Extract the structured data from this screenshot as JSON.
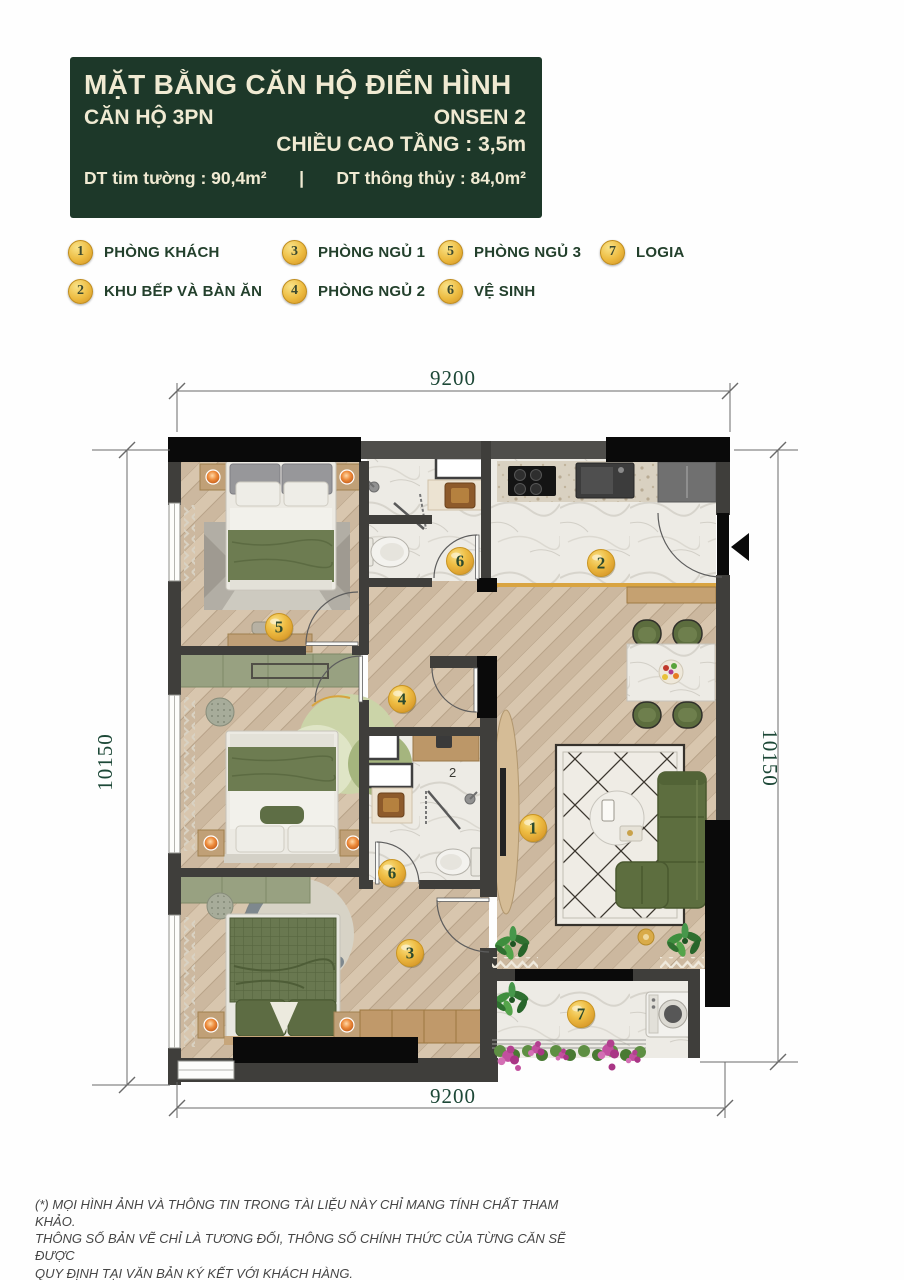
{
  "header": {
    "title": "MẶT BẰNG CĂN HỘ ĐIỂN HÌNH",
    "unit_type": "CĂN HỘ 3PN",
    "project_name": "ONSEN 2",
    "floor_height": "CHIỀU CAO TẦNG : 3,5m",
    "area_gross": "DT tim tường : 90,4m²",
    "divider": "|",
    "area_net": "DT thông thủy : 84,0m²",
    "bg_color": "#1d3829",
    "text_color": "#f0ead2"
  },
  "legend": {
    "items": [
      {
        "num": "1",
        "label": "PHÒNG KHÁCH"
      },
      {
        "num": "2",
        "label": "KHU BẾP VÀ BÀN ĂN"
      },
      {
        "num": "3",
        "label": "PHÒNG NGỦ 1"
      },
      {
        "num": "4",
        "label": "PHÒNG NGỦ 2"
      },
      {
        "num": "5",
        "label": "PHÒNG NGỦ 3"
      },
      {
        "num": "6",
        "label": "VỆ SINH"
      },
      {
        "num": "7",
        "label": "LOGIA"
      }
    ],
    "columns": [
      [
        0,
        1
      ],
      [
        2,
        3
      ],
      [
        4,
        5
      ],
      [
        6
      ]
    ]
  },
  "plan": {
    "dimensions": {
      "top": "9200",
      "bottom": "9200",
      "left": "10150",
      "right": "10150"
    },
    "markers": [
      {
        "num": "1",
        "x": 533,
        "y": 828
      },
      {
        "num": "2",
        "x": 601,
        "y": 563
      },
      {
        "num": "3",
        "x": 410,
        "y": 953
      },
      {
        "num": "4",
        "x": 402,
        "y": 699
      },
      {
        "num": "5",
        "x": 279,
        "y": 627
      },
      {
        "num": "6",
        "x": 460,
        "y": 561
      },
      {
        "num": "6",
        "x": 392,
        "y": 873
      },
      {
        "num": "7",
        "x": 581,
        "y": 1014
      }
    ],
    "bath2_label": "2",
    "marker_color": "#eeb83d",
    "dim_color": "#1d4837"
  },
  "footnote": {
    "lines": [
      "(*) MỌI HÌNH ẢNH VÀ THÔNG TIN TRONG TÀI LIỆU NÀY CHỈ MANG TÍNH  CHẤT THAM KHẢO.",
      "THÔNG SỐ BẢN VẼ CHỈ LÀ TƯƠNG ĐỐI, THÔNG SỐ CHÍNH THỨC CỦA TỪNG CĂN SẼ ĐƯỢC",
      "QUY ĐỊNH TẠI VĂN BẢN KÝ KẾT VỚI KHÁCH HÀNG."
    ]
  }
}
